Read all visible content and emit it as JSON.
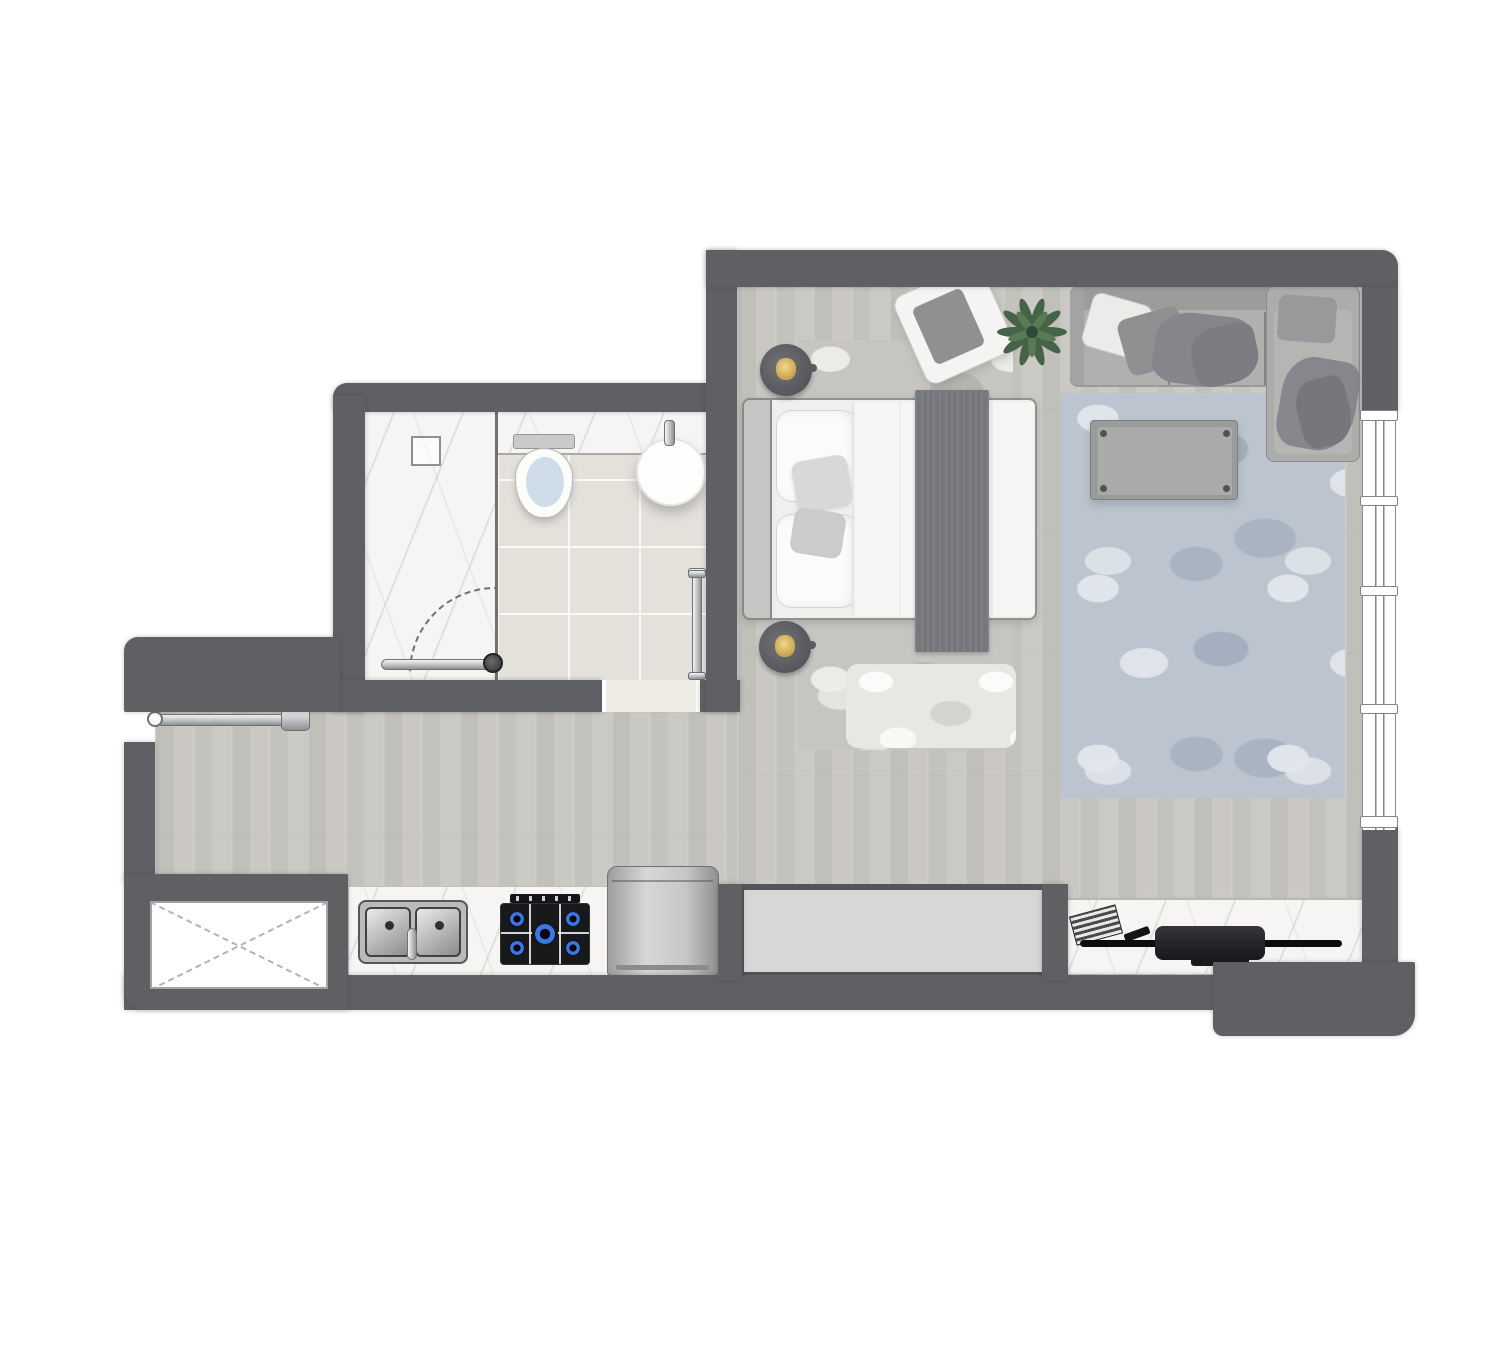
{
  "plan_label": "studio-apartment-floor-plan",
  "colors": {
    "wall": "#5e6064",
    "floor": "#c8c6c1",
    "tile": "#e4e1db",
    "marble": "#f6f5f3",
    "rug_gray": "#c6c5c1",
    "rug_blue": "#bcc5cf",
    "sofa": "#b0b0ae",
    "table": "#9a9c9a",
    "steel": "#c7c8c9",
    "hob": "#18191b",
    "gold": "#c9a24e",
    "seat_blue": "#cfdcea",
    "closet": "#d7d8d6",
    "runner": "#75777c",
    "plant": "#4a6a4a"
  },
  "rooms": {
    "bathroom": {
      "label": "bathroom",
      "fixtures": [
        "shower",
        "glass-screen",
        "floor-drain",
        "door-swing-arc",
        "toilet",
        "washbasin",
        "towel-rail"
      ]
    },
    "living": {
      "label": "bedroom-living-area",
      "furniture": [
        "double-bed",
        "bedside-lamp-top",
        "bedside-lamp-bottom",
        "armchair",
        "potted-plant",
        "sectional-sofa",
        "coffee-table",
        "blue-area-rug",
        "bed-rug",
        "tv-console",
        "television"
      ]
    },
    "kitchen": {
      "label": "kitchen-hallway",
      "fixtures": [
        "entry-sliding-door",
        "service-shaft",
        "kitchen-counter",
        "double-bowl-sink",
        "gas-hob-5-burner",
        "refrigerator",
        "wardrobe-cabinet"
      ]
    }
  },
  "window": {
    "label": "east-window-wall",
    "panes": 4
  },
  "doors": [
    {
      "label": "entry-door",
      "type": "sliding"
    },
    {
      "label": "bathroom-door",
      "type": "swing"
    }
  ]
}
